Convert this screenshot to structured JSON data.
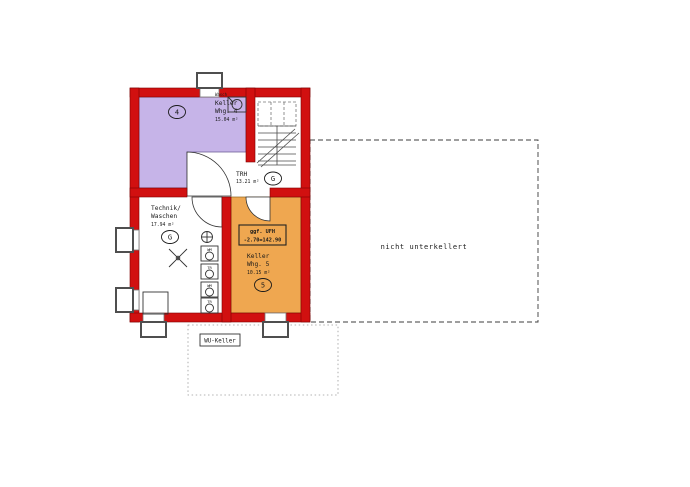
{
  "colors": {
    "wall_red": "#d11010",
    "wall_edge": "#7e0000",
    "room4": "#c6b4e8",
    "room5": "#efa750"
  },
  "rooms": {
    "whg4": {
      "line1": "Keller",
      "line2": "Whg. 4",
      "area": "15.04 m²",
      "mark": "4"
    },
    "trh": {
      "line1": "TRH",
      "area": "13.21 m²",
      "mark": "G"
    },
    "technik": {
      "line1": "Technik/",
      "line2": "Waschen",
      "area": "17.94 m²",
      "mark": "G"
    },
    "whg5": {
      "line1": "Keller",
      "line2": "Whg. 5",
      "area": "10.15 m²",
      "mark": "5"
    }
  },
  "annotations": {
    "nicht_unterkellert": "nicht unterkellert",
    "wu_keller": "WU-Keller",
    "ufh_line1": "ggf. UFH",
    "ufh_line2": "-2.70=142.90",
    "wasch": "Wasch"
  },
  "appliances": [
    "WM",
    "TR",
    "WM",
    "TR"
  ]
}
